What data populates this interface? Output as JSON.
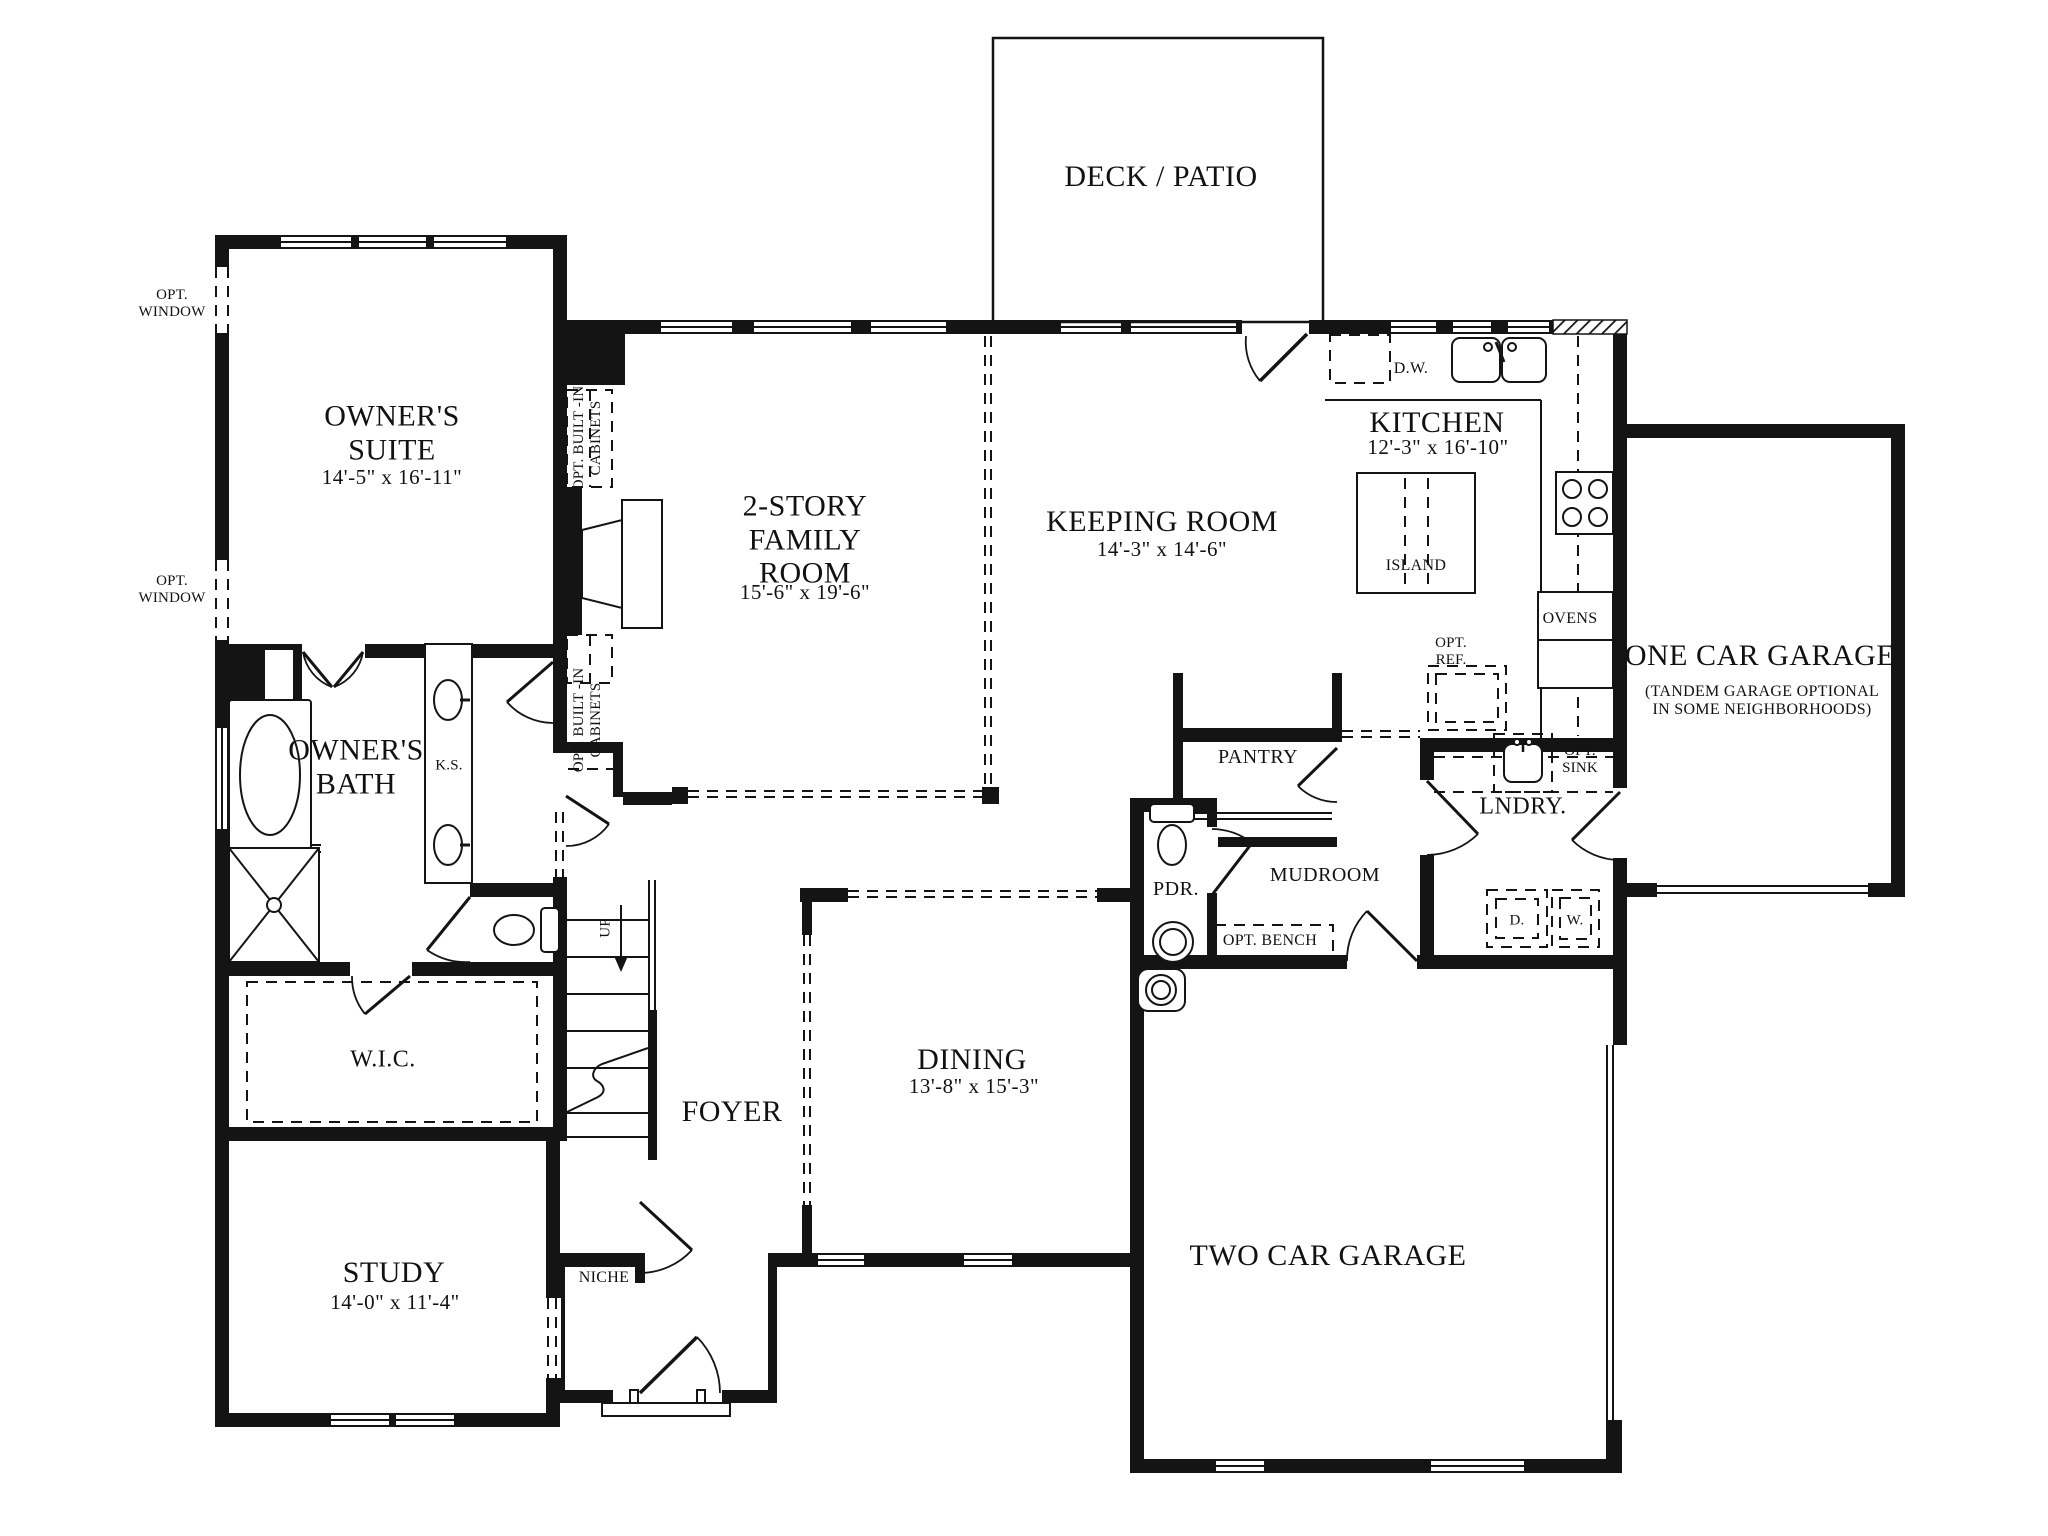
{
  "colors": {
    "ink": "#141414",
    "background": "#ffffff"
  },
  "rooms": {
    "deck": {
      "name": "DECK / PATIO"
    },
    "owners_suite": {
      "name": "OWNER'S\nSUITE",
      "dims": "14'-5\" x 16'-11\""
    },
    "family_room": {
      "name": "2-STORY\nFAMILY\nROOM",
      "dims": "15'-6\" x 19'-6\""
    },
    "keeping_room": {
      "name": "KEEPING ROOM",
      "dims": "14'-3\" x 14'-6\""
    },
    "kitchen": {
      "name": "KITCHEN",
      "dims": "12'-3\" x 16'-10\""
    },
    "one_car_garage": {
      "name": "ONE CAR GARAGE",
      "note": "(TANDEM GARAGE OPTIONAL\nIN SOME NEIGHBORHOODS)"
    },
    "two_car_garage": {
      "name": "TWO CAR GARAGE"
    },
    "dining": {
      "name": "DINING",
      "dims": "13'-8\" x 15'-3\""
    },
    "foyer": {
      "name": "FOYER"
    },
    "study": {
      "name": "STUDY",
      "dims": "14'-0\" x 11'-4\""
    },
    "wic": {
      "name": "W.I.C."
    },
    "owners_bath": {
      "name": "OWNER'S\nBATH"
    },
    "laundry": {
      "name": "LNDRY."
    },
    "pantry": {
      "name": "PANTRY"
    },
    "mudroom": {
      "name": "MUDROOM"
    },
    "powder": {
      "name": "PDR."
    }
  },
  "annotations": {
    "opt_window": "OPT.\nWINDOW",
    "opt_cabinets": "OPT. BUILT -IN\nCABINETS",
    "dishwasher": "D.W.",
    "island": "ISLAND",
    "ovens": "OVENS",
    "opt_ref": "OPT.\nREF.",
    "opt_sink": "OPT.\nSINK",
    "knee_space": "K.S.",
    "dryer": "D.",
    "washer": "W.",
    "opt_bench": "OPT. BENCH",
    "niche": "NICHE",
    "up": "UP"
  }
}
